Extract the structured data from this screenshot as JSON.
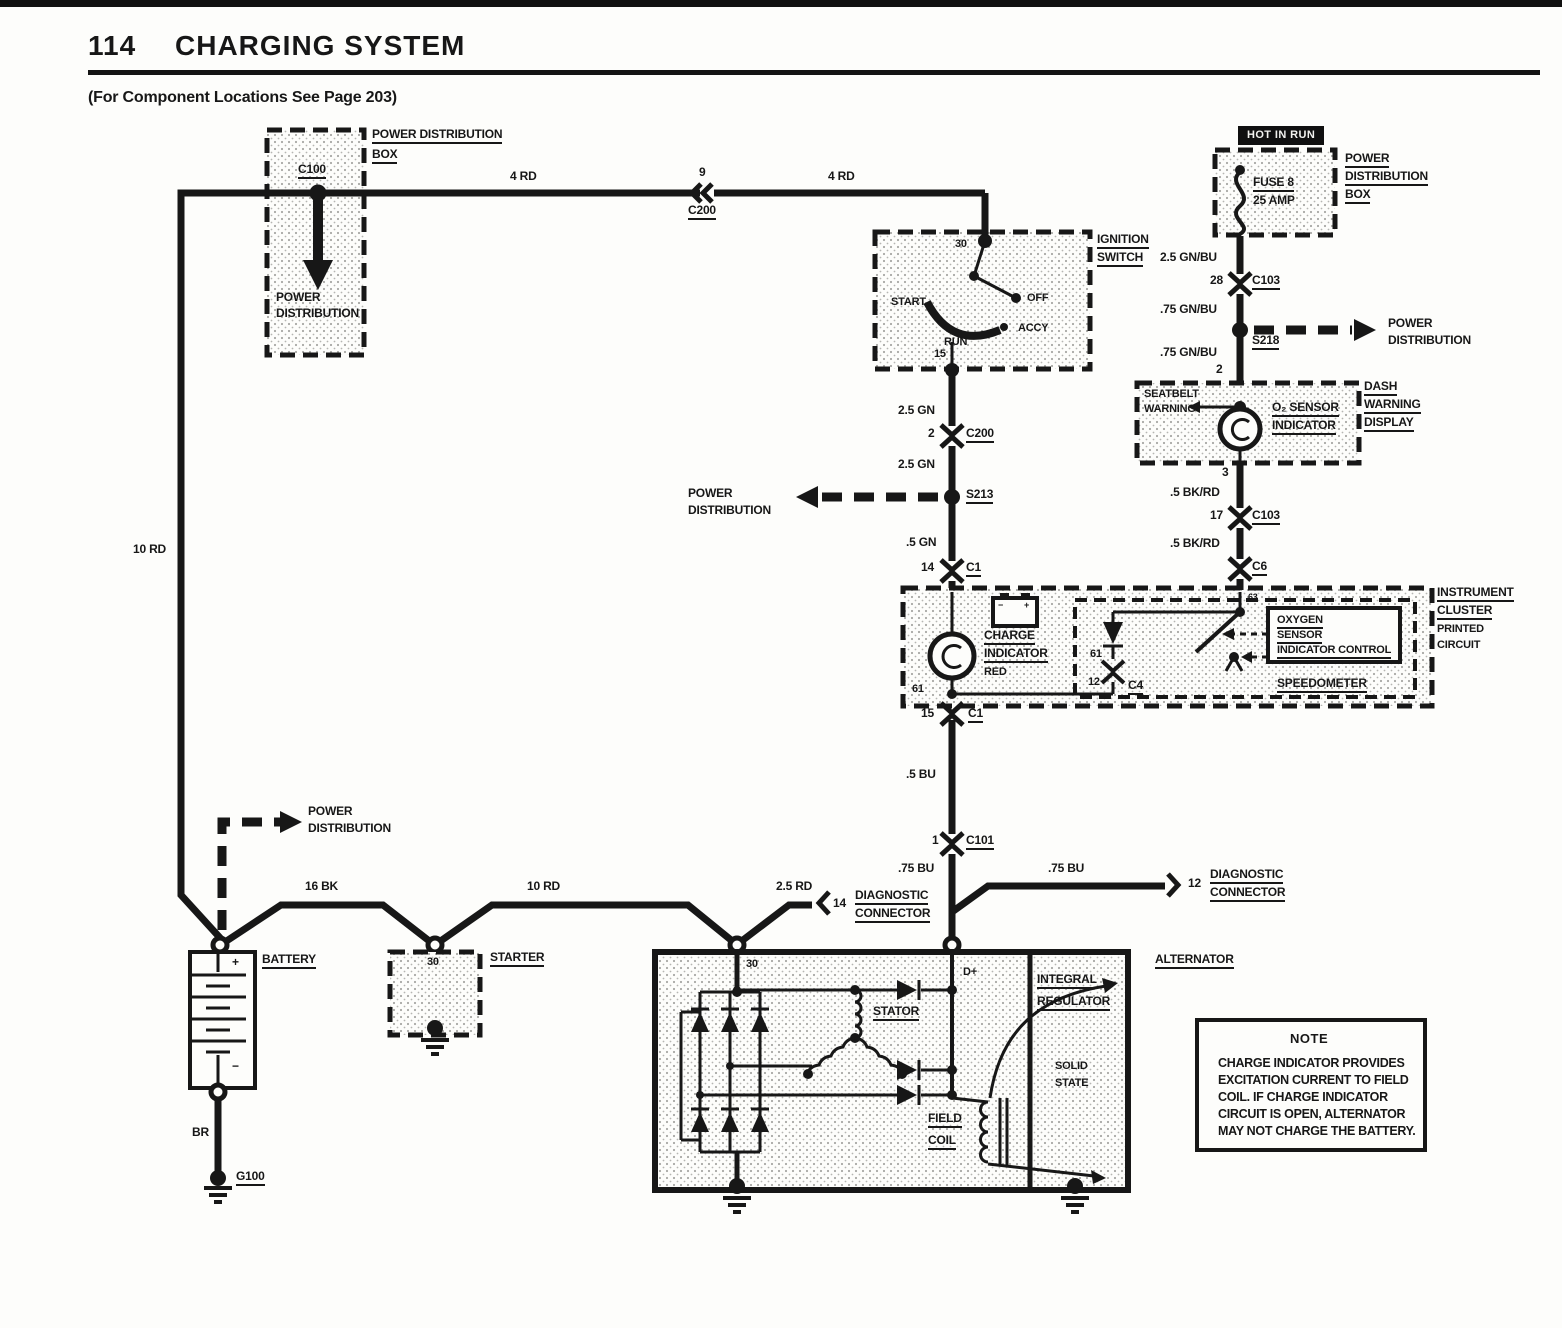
{
  "colors": {
    "ink": "#171717",
    "paper": "#fdfdfb",
    "stipple": "#a8a8a4"
  },
  "header": {
    "page_number": "114",
    "title": "CHARGING SYSTEM",
    "subtitle": "(For Component Locations See Page 203)"
  },
  "pdb_left": {
    "label1": "POWER DISTRIBUTION",
    "label2": "BOX",
    "connector": "C100",
    "arrow_label1": "POWER",
    "arrow_label2": "DISTRIBUTION"
  },
  "top_wire": {
    "gauge_left": "4 RD",
    "pin": "9",
    "connector": "C200",
    "gauge_right": "4 RD",
    "left_gauge": "10 RD"
  },
  "ignition": {
    "label1": "IGNITION",
    "label2": "SWITCH",
    "pin_top": "30",
    "pin_bottom": "15",
    "start": "START",
    "off": "OFF",
    "accy": "ACCY",
    "run": "RUN"
  },
  "mid": {
    "w1": "2.5 GN",
    "c200_pin": "2",
    "c200": "C200",
    "w2": "2.5 GN",
    "s213": "S213",
    "pd1": "POWER",
    "pd2": "DISTRIBUTION",
    "w3": ".5 GN",
    "c1_pin": "14",
    "c1": "C1"
  },
  "pdb_right": {
    "hot": "HOT IN RUN",
    "label1": "POWER",
    "label2": "DISTRIBUTION",
    "label3": "BOX",
    "fuse1": "FUSE 8",
    "fuse2": "25 AMP"
  },
  "right": {
    "w1": "2.5 GN/BU",
    "c103_pin": "28",
    "c103": "C103",
    "w2": ".75 GN/BU",
    "s218": "S218",
    "pd1": "POWER",
    "pd2": "DISTRIBUTION",
    "w3": ".75 GN/BU",
    "pin2": "2",
    "pin3": "3",
    "w4": ".5 BK/RD",
    "c103b_pin": "17",
    "c103b": "C103",
    "w5": ".5 BK/RD",
    "c6": "C6",
    "pin63": "63"
  },
  "dash_display": {
    "seatbelt1": "SEATBELT",
    "seatbelt2": "WARNING",
    "o2a": "O₂ SENSOR",
    "o2b": "INDICATOR",
    "label1": "DASH",
    "label2": "WARNING",
    "label3": "DISPLAY"
  },
  "cluster": {
    "label1": "INSTRUMENT",
    "label2": "CLUSTER",
    "label3": "PRINTED",
    "label4": "CIRCUIT",
    "charge1": "CHARGE",
    "charge2": "INDICATOR",
    "charge3": "RED",
    "batt_minus": "−",
    "batt_plus": "+",
    "pin61": "61",
    "pin61b": "61",
    "c4_pin": "12",
    "c4": "C4",
    "ox1": "OXYGEN",
    "ox2": "SENSOR",
    "ox3": "INDICATOR CONTROL",
    "speedo": "SPEEDOMETER",
    "c1_pin": "15",
    "c1": "C1"
  },
  "lower": {
    "w1": ".5 BU",
    "c101_pin": "1",
    "c101": "C101",
    "w2": ".75 BU",
    "w3": ".75 BU",
    "diag_pin": "12",
    "diag1": "DIAGNOSTIC",
    "diag2": "CONNECTOR"
  },
  "bottom": {
    "pd1": "POWER",
    "pd2": "DISTRIBUTION",
    "w16bk": "16 BK",
    "w10rd": "10 RD",
    "w25rd": "2.5 RD",
    "diag_pin": "14",
    "diag1": "DIAGNOSTIC",
    "diag2": "CONNECTOR"
  },
  "battery": {
    "label": "BATTERY",
    "plus": "+",
    "minus": "−",
    "wire": "BR",
    "ground": "G100"
  },
  "starter": {
    "label": "STARTER",
    "pin": "30"
  },
  "alternator": {
    "label": "ALTERNATOR",
    "pin30": "30",
    "dplus": "D+",
    "stator": "STATOR",
    "field1": "FIELD",
    "field2": "COIL",
    "reg1": "INTEGRAL",
    "reg2": "REGULATOR",
    "solid1": "SOLID",
    "solid2": "STATE"
  },
  "note": {
    "title": "NOTE",
    "line1": "CHARGE INDICATOR PROVIDES",
    "line2": "EXCITATION CURRENT TO FIELD",
    "line3": "COIL. IF CHARGE INDICATOR",
    "line4": "CIRCUIT IS OPEN, ALTERNATOR",
    "line5": "MAY NOT CHARGE THE BATTERY."
  }
}
